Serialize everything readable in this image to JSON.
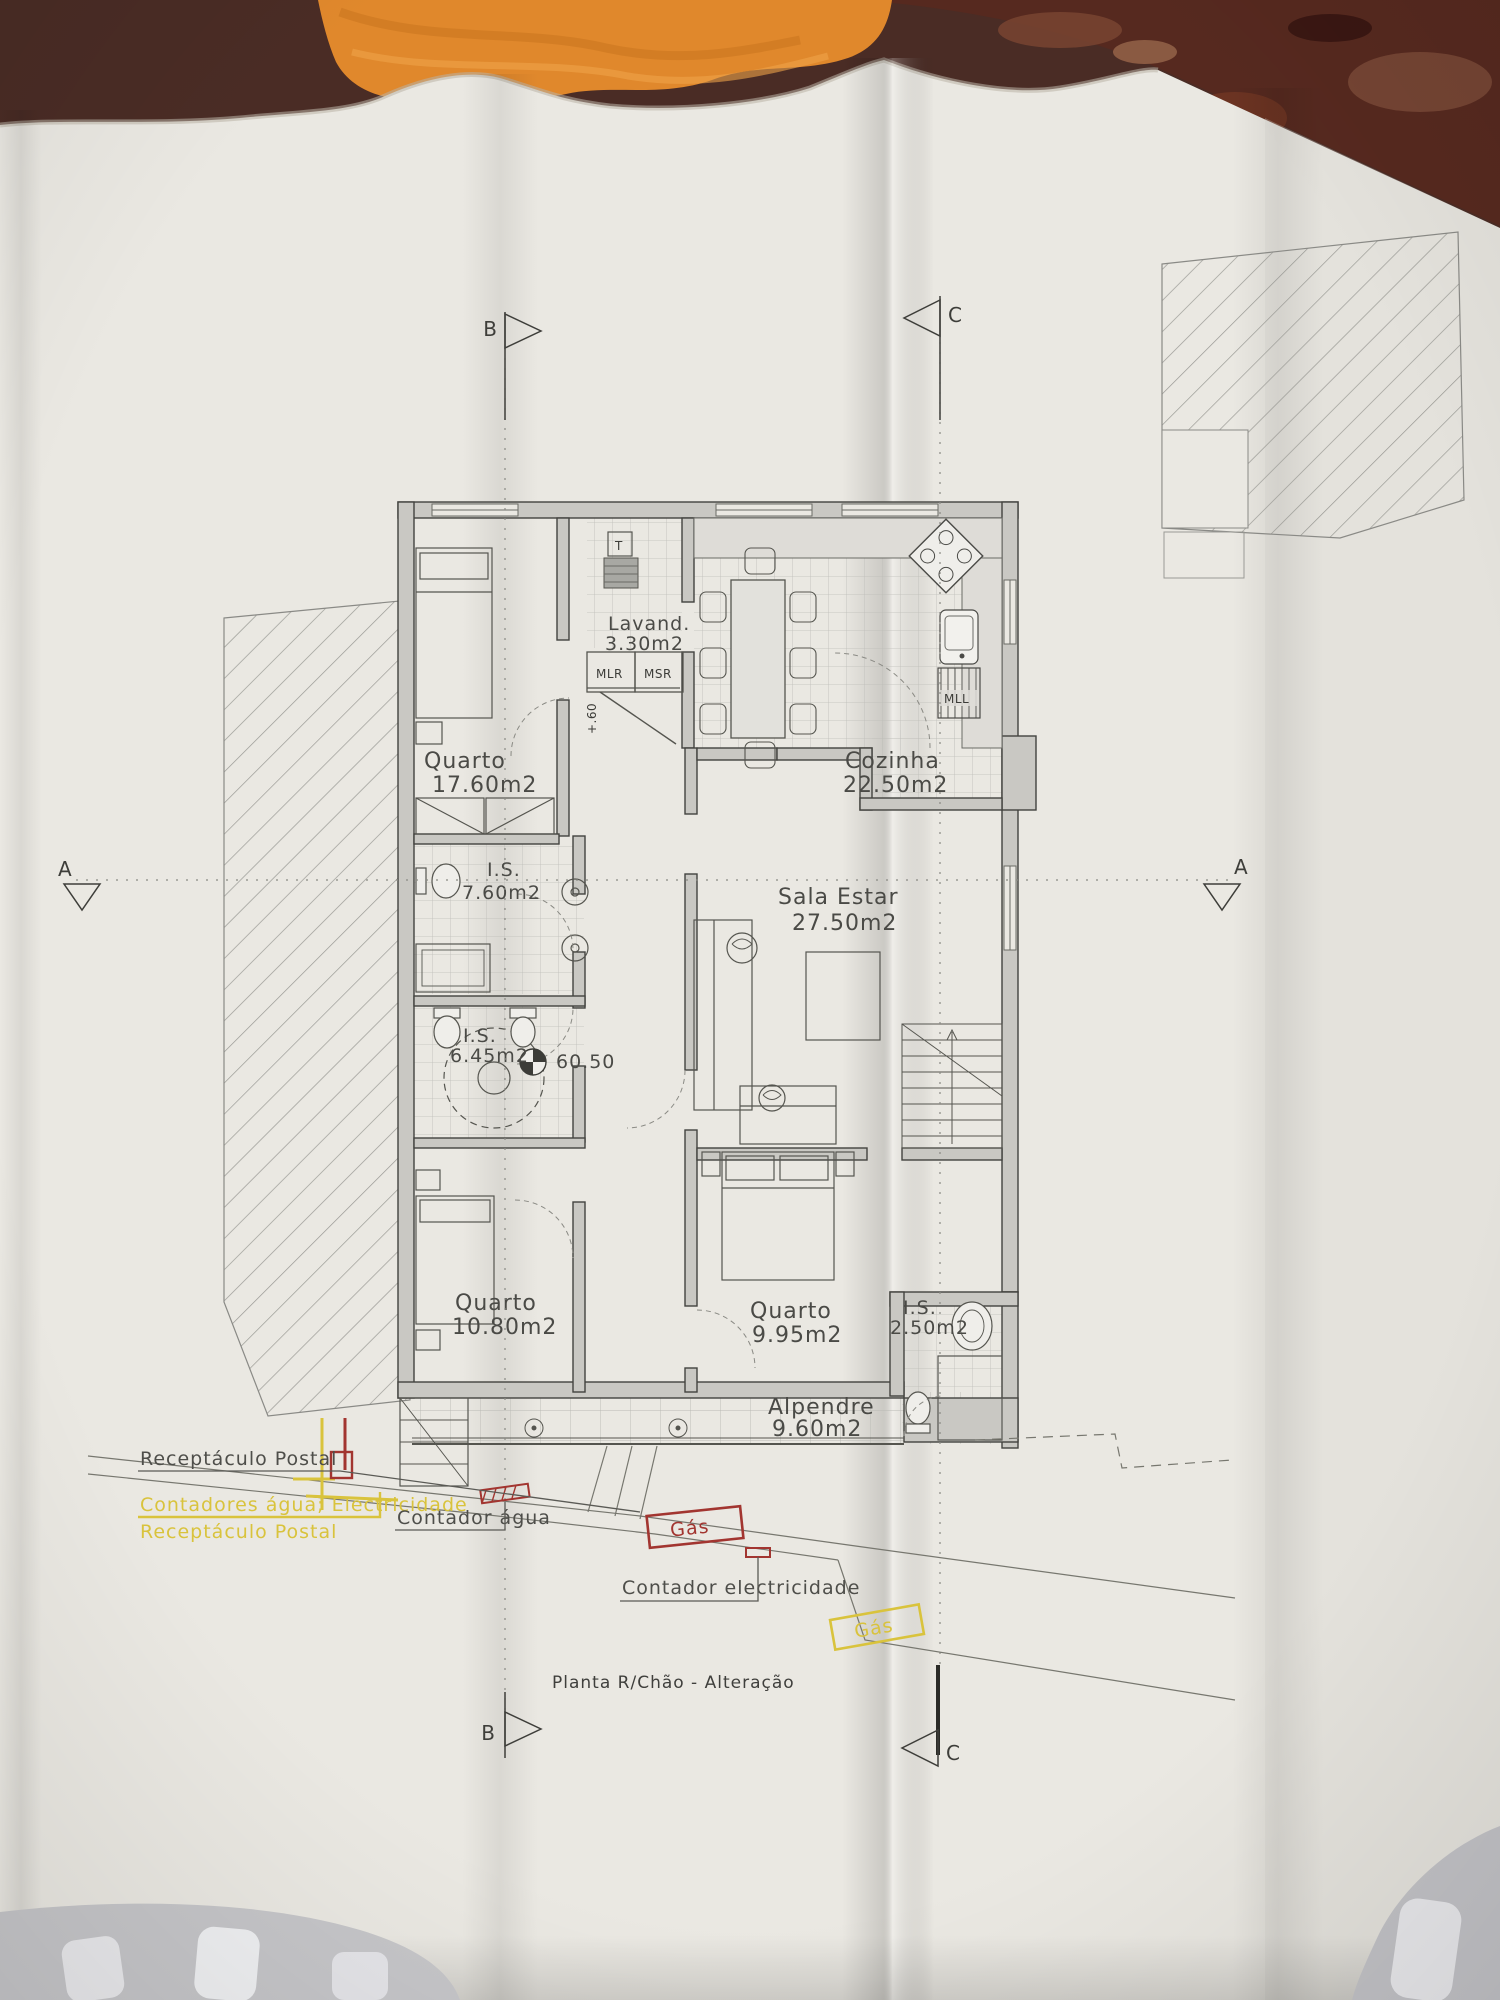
{
  "title": {
    "label": "Planta R/Chão - Alteração"
  },
  "markers": {
    "a": "A",
    "b": "B",
    "c": "C"
  },
  "rooms": [
    {
      "name": "Quarto",
      "area": "17.60m2"
    },
    {
      "name": "Lavand.",
      "area": "3.30m2"
    },
    {
      "name": "Cozinha",
      "area": "22.50m2"
    },
    {
      "name": "I.S.",
      "area": "7.60m2"
    },
    {
      "name": "Sala  Estar",
      "area": "27.50m2"
    },
    {
      "name": "I.S.",
      "area": "6.45m2"
    },
    {
      "name": "Quarto",
      "area": "10.80m2"
    },
    {
      "name": "Quarto",
      "area": "9.95m2"
    },
    {
      "name": "I.S.",
      "area": "2.50m2"
    },
    {
      "name": "Alpendre",
      "area": "9.60m2"
    }
  ],
  "labels": {
    "t": "T",
    "mlr": "MLR",
    "msr": "MSR",
    "mll": "MLL"
  },
  "levels": {
    "floor": "60.50",
    "entry": "+.60"
  },
  "annotations": {
    "postal_black": "Receptáculo Postal",
    "meters_yellow": "Contadores água; Electricidade",
    "postal_yellow": "Receptáculo Postal",
    "water_meter": "Contador água",
    "gas_red": "Gás",
    "electricity_meter": "Contador electricidade",
    "gas_yellow": "Gás"
  },
  "colors": {
    "annotation_yellow": "#d9c33c",
    "annotation_red": "#a23530",
    "towel_orange": "#e0882c",
    "surface_brown": "#4a2c25",
    "paper": "#eae8e2"
  }
}
